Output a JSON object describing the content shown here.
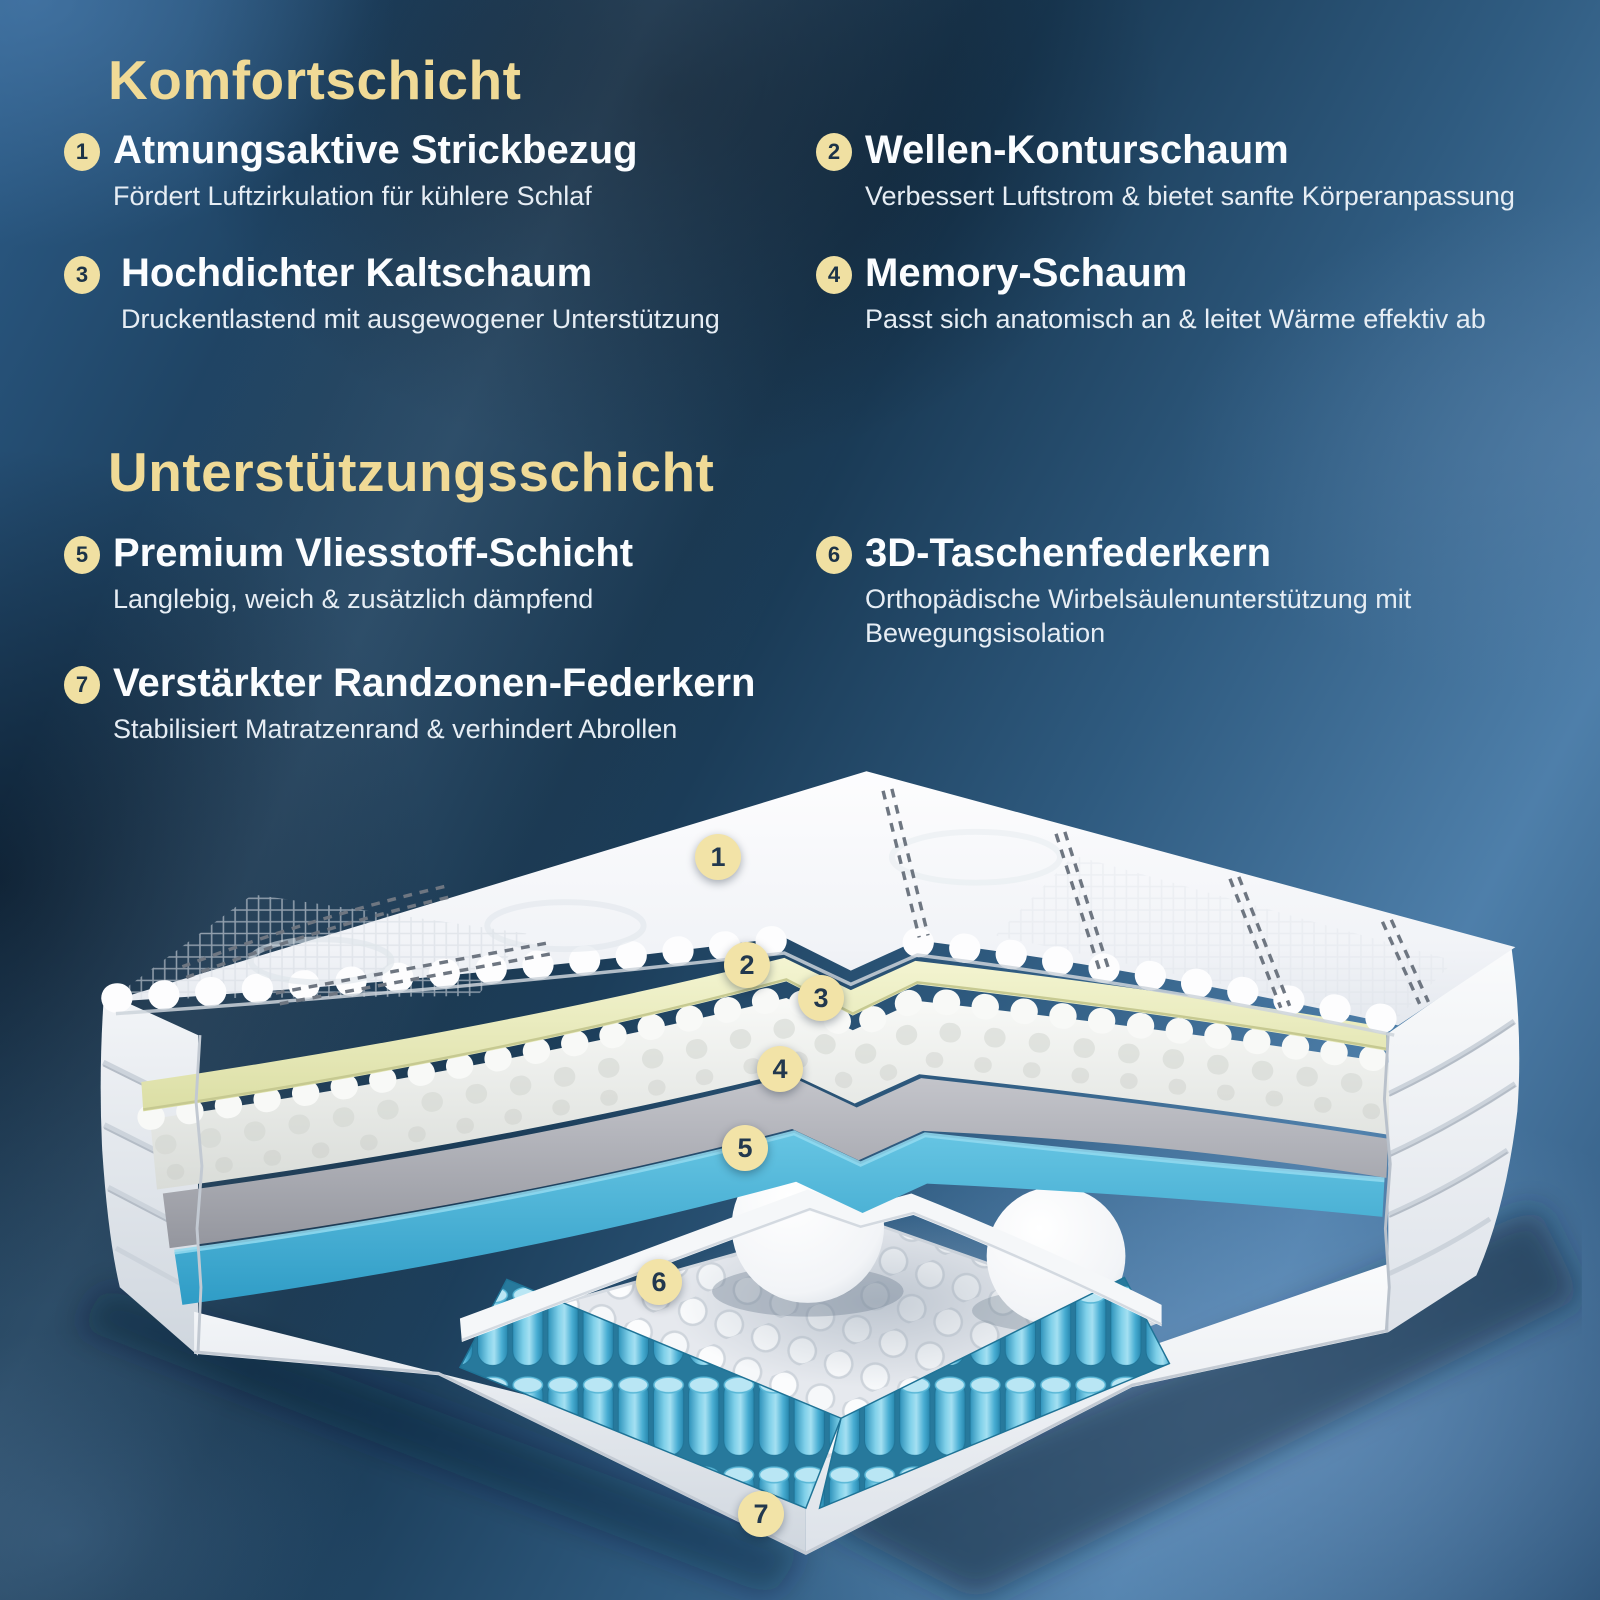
{
  "sections": [
    {
      "title": "Komfortschicht",
      "items": [
        {
          "num": "1",
          "title": "Atmungsaktive Strickbezug",
          "desc": "Fördert Luftzirkulation für kühlere Schlaf"
        },
        {
          "num": "2",
          "title": "Wellen-Konturschaum",
          "desc": "Verbessert Luftstrom & bietet sanfte Körperanpassung"
        },
        {
          "num": "3",
          "title": "Hochdichter Kaltschaum",
          "desc": "Druckentlastend mit ausgewogener Unterstützung"
        },
        {
          "num": "4",
          "title": "Memory-Schaum",
          "desc": "Passt sich anatomisch an & leitet Wärme effektiv ab"
        }
      ]
    },
    {
      "title": "Unterstützungsschicht",
      "items": [
        {
          "num": "5",
          "title": "Premium Vliesstoff-Schicht",
          "desc": "Langlebig, weich & zusätzlich dämpfend"
        },
        {
          "num": "6",
          "title": "3D-Taschenfederkern",
          "desc": "Orthopädische Wirbelsäulenunterstützung mit Bewegungsisolation"
        },
        {
          "num": "7",
          "title": "Verstärkter Randzonen-Federkern",
          "desc": "Stabilisiert Matratzenrand & verhindert Abrollen"
        }
      ]
    }
  ],
  "diagram": {
    "markers": [
      {
        "num": "1"
      },
      {
        "num": "2"
      },
      {
        "num": "3"
      },
      {
        "num": "4"
      },
      {
        "num": "5"
      },
      {
        "num": "6"
      },
      {
        "num": "7"
      }
    ]
  },
  "colors": {
    "accent_gold": "#f0da96",
    "badge_fill": "#f0e0a2",
    "badge_text": "#1c3347",
    "title_text": "#fbfdff",
    "desc_text": "#e6edf4",
    "foam_yellow": "#ecedb9",
    "foam_gray": "#a7a9b0",
    "foam_blue": "#4db4da",
    "spring_blue": "#3aa6cf",
    "background_navy": "#16344d"
  }
}
